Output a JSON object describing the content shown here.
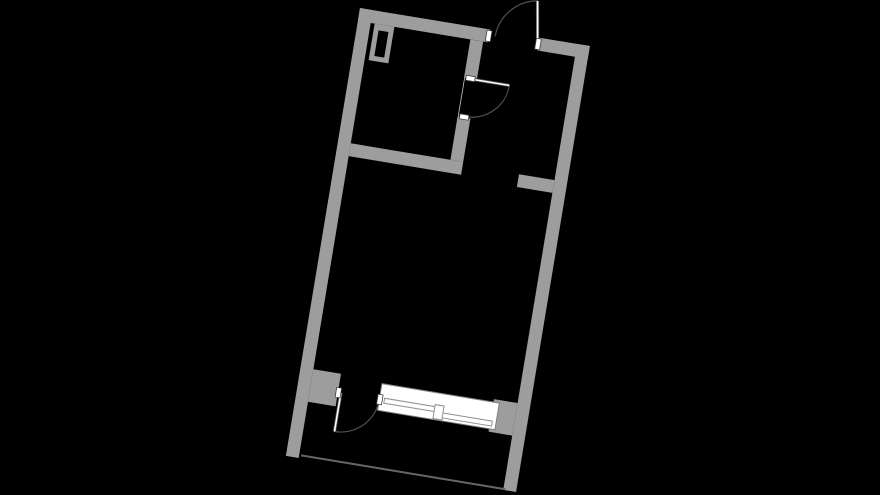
{
  "canvas": {
    "width": 880,
    "height": 495
  },
  "floorplan": {
    "type": "apartment-floor-plan",
    "rotation_deg": 9.4,
    "transform": "translate(360 8) rotate(9.4)",
    "colors": {
      "background": "#000000",
      "wall": "#9d9d9d",
      "floor": "#000000",
      "doorline": "#4f4f4f",
      "leaffill": "#ffffff",
      "windowfill": "#ffffff",
      "windowstroke": "#7f7f7f",
      "panestroke": "#8f8f8f",
      "jambfill": "#ffffff",
      "jambstroke": "#3f3f3f",
      "openingline": "#c8c8c8",
      "balconyline": "#666666"
    },
    "elements": [
      "entry-door-with-outward-swing",
      "interior-room-door-with-swing",
      "balcony-door-with-outward-swing",
      "sliding-balcony-window",
      "duct-shaft",
      "partition-stub",
      "balcony-edge-line"
    ]
  }
}
